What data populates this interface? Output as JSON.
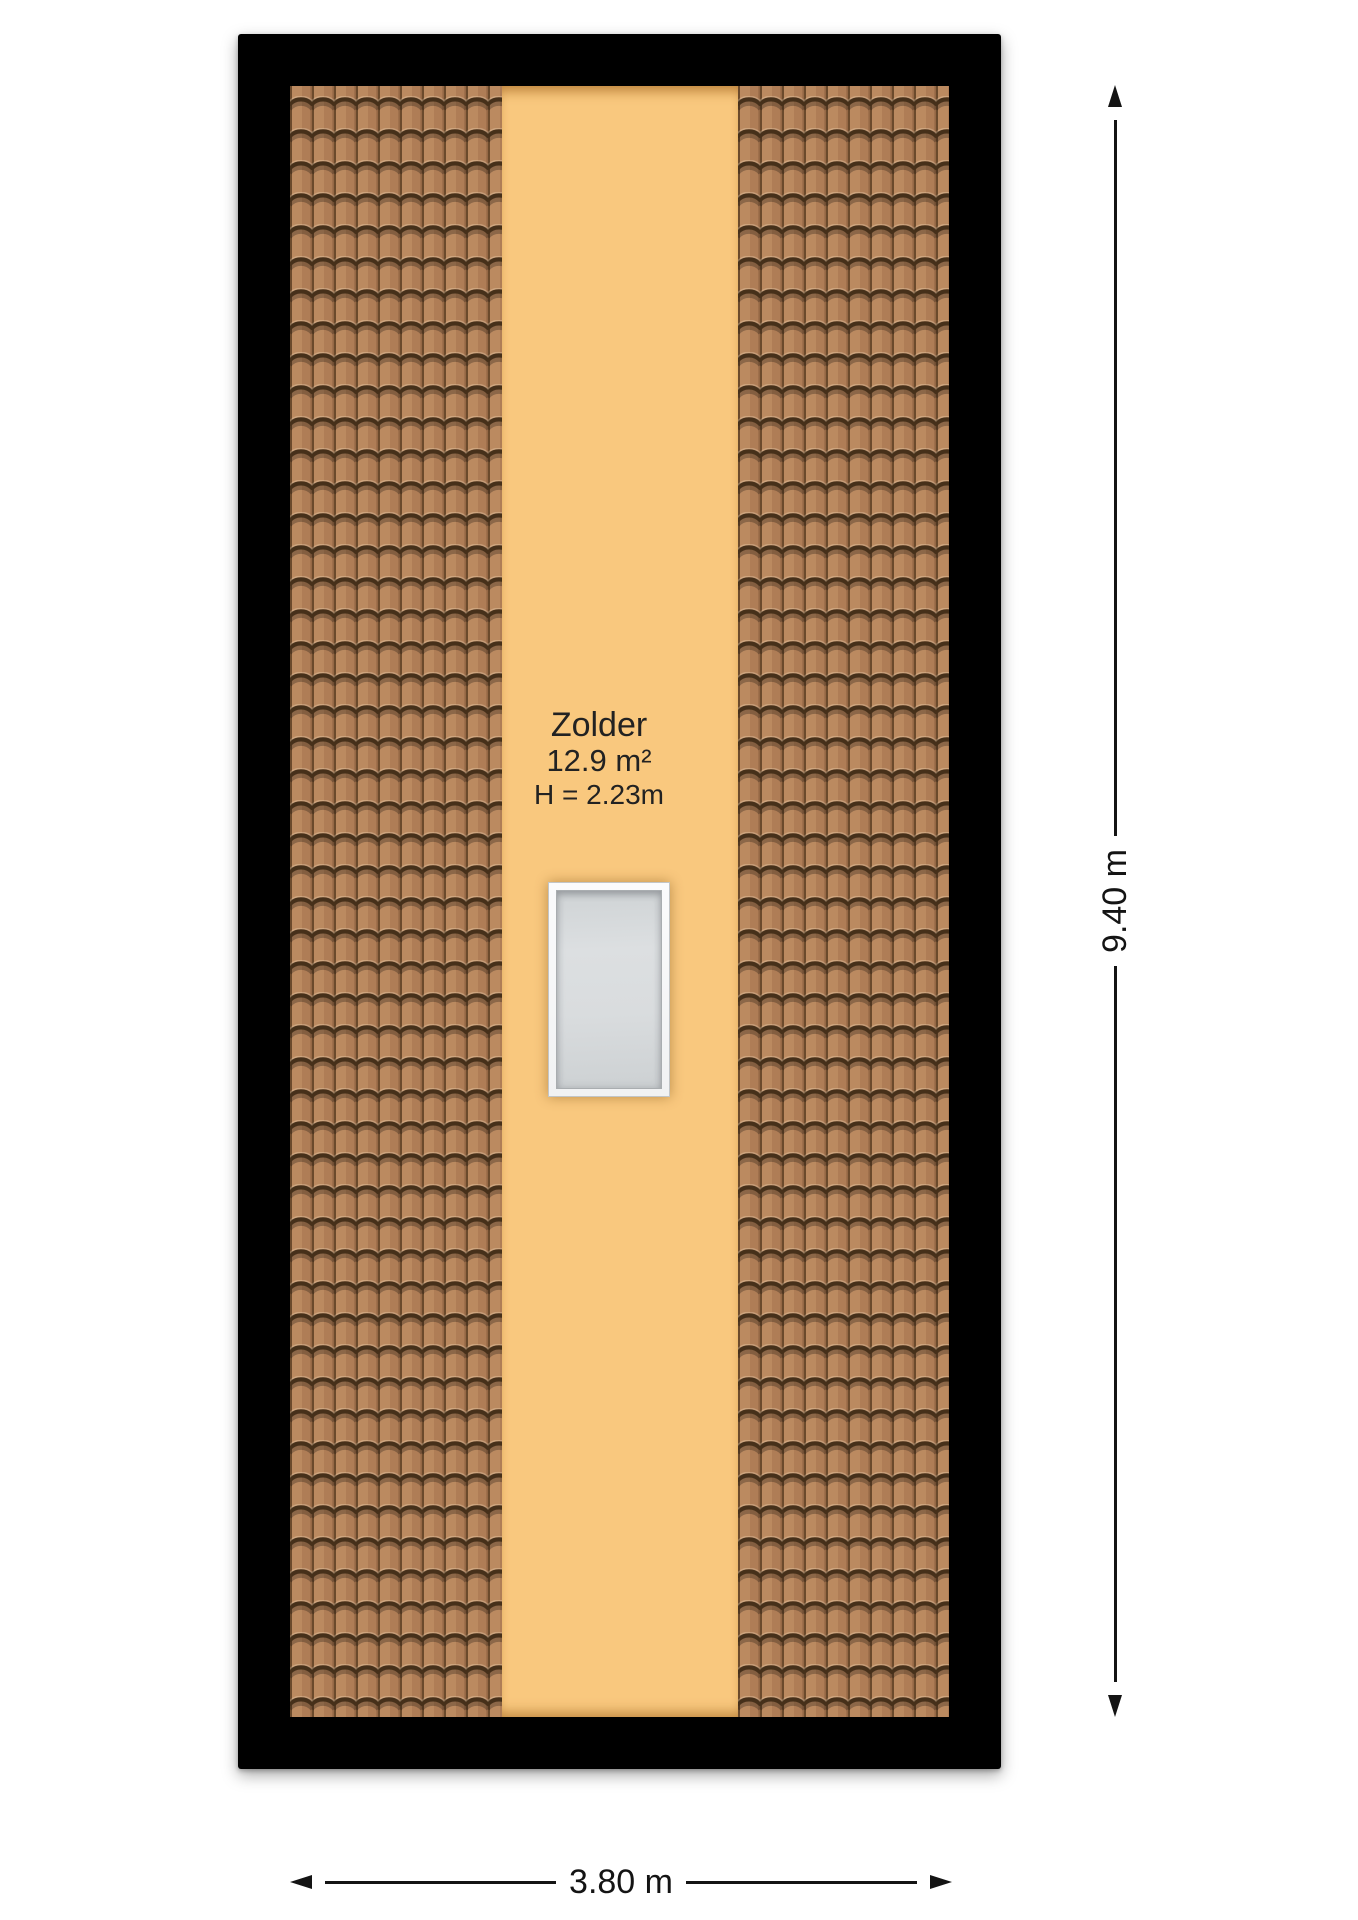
{
  "floorplan": {
    "type": "attic-floor-plan",
    "room": {
      "name": "Zolder",
      "area": "12.9 m²",
      "ceiling_height": "H = 2.23m"
    },
    "dimensions": {
      "vertical_label": "9.40 m",
      "horizontal_label": "3.80 m"
    },
    "features": {
      "skylight": "skylight-window",
      "roof_left": "tiled-roof-slope",
      "roof_right": "tiled-roof-slope"
    },
    "colors": {
      "wall_outline": "#000000",
      "floor_fill": "#f9c87e",
      "roof_tile": "#af7d56",
      "roof_tile_light": "#bb8a60",
      "roof_tile_groove": "#46301a",
      "skylight_frame": "#ffffff",
      "skylight_glass": "#d7dadc",
      "dimension_ink": "#141414",
      "canvas": "#ffffff"
    }
  }
}
